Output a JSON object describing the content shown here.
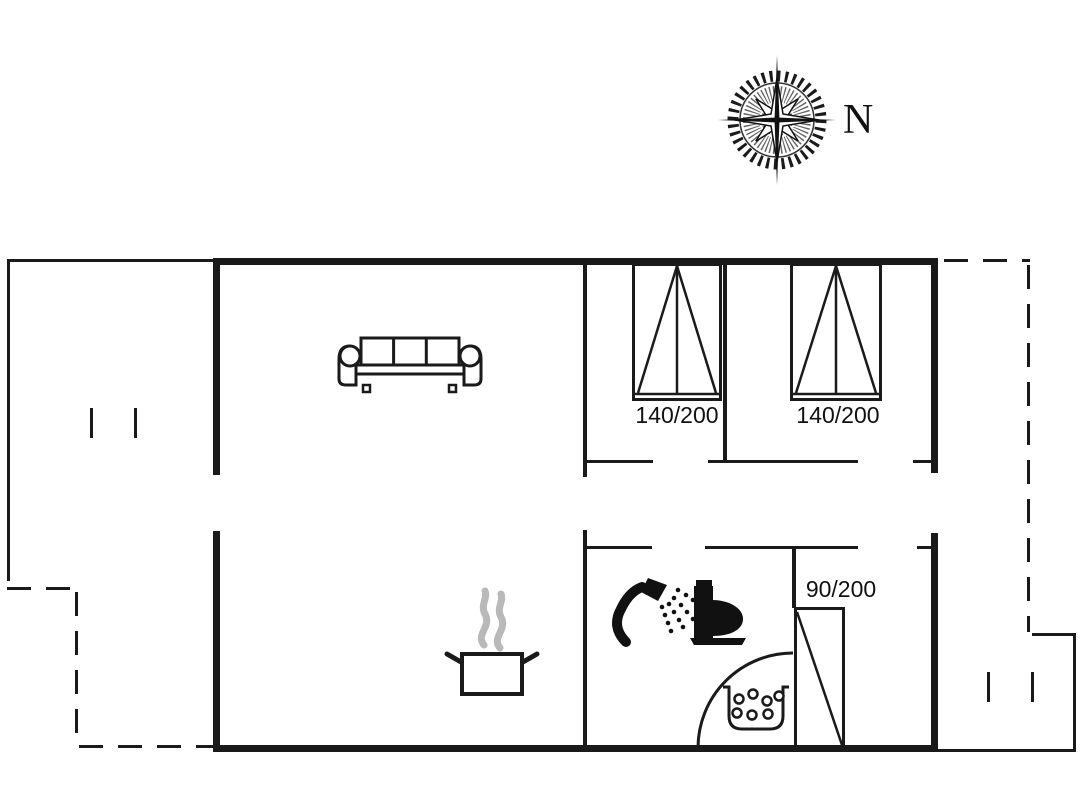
{
  "compass": {
    "north_label": "N"
  },
  "beds": {
    "bed1_size": "140/200",
    "bed2_size": "140/200",
    "bed3_size": "90/200"
  },
  "colors": {
    "line": "#1a1a1a",
    "steam_gray": "#b9b9b9",
    "background": "#ffffff"
  },
  "icons": {
    "compass-rose-icon": "8-point compass rose with toothed ring",
    "sofa-icon": "3-seat sofa, top view",
    "double-bed-icon": "double bed, top view",
    "single-bed-icon": "single bed with diagonal, top view",
    "cooking-pot-steam-icon": "pot with rising steam (kitchen)",
    "shower-head-icon": "hand shower spraying",
    "toilet-icon": "toilet, side silhouette",
    "shower-tray-bubbles-icon": "shower tray with bubbles",
    "door-swing-arc": "quarter-circle swing arc"
  }
}
